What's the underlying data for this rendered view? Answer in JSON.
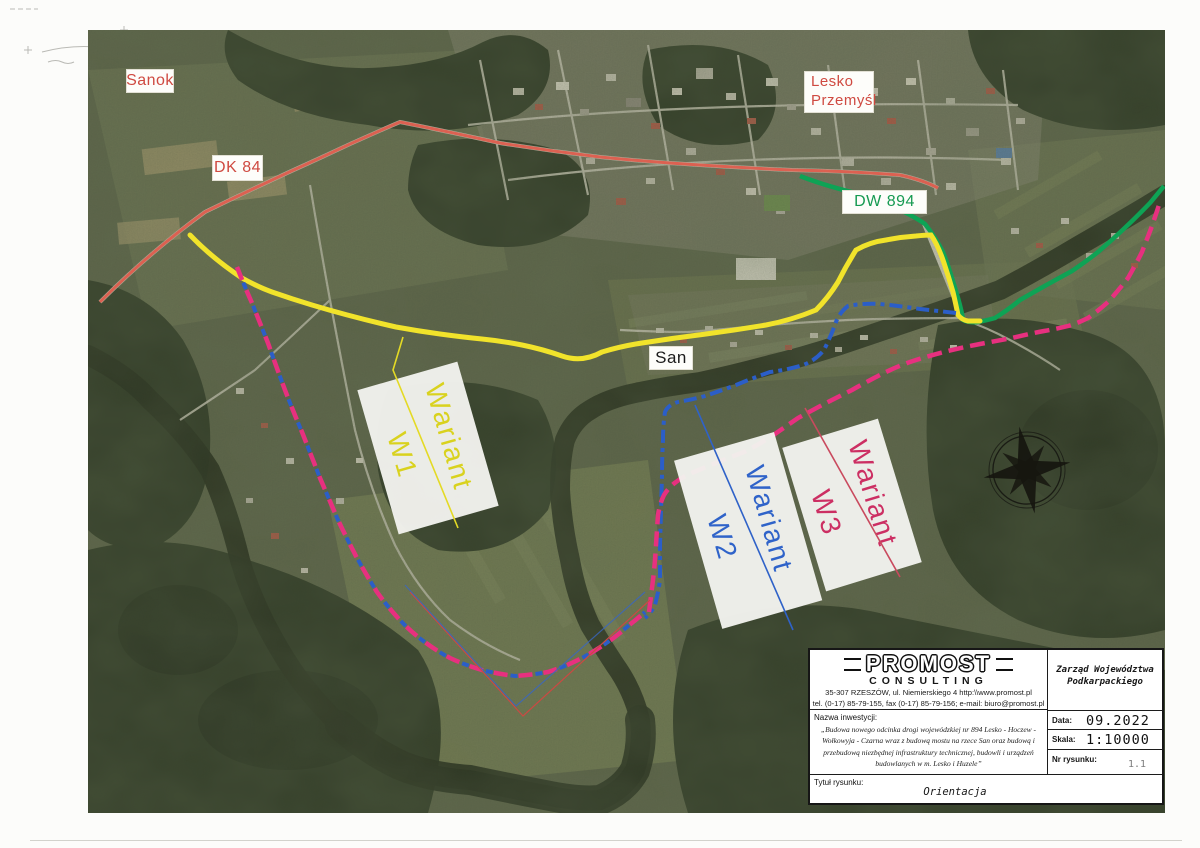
{
  "map": {
    "place_labels": {
      "sanok": "Sanok",
      "lesko_line1": "Lesko",
      "lesko_line2": "Przemyśl",
      "san": "San"
    },
    "road_labels": {
      "dk84": "DK 84",
      "dw894": "DW 894"
    },
    "variants": [
      {
        "word": "Wariant",
        "code": "W1",
        "color": "#ddd51e"
      },
      {
        "word": "Wariant",
        "code": "W2",
        "color": "#2f63c9"
      },
      {
        "word": "Wariant",
        "code": "W3",
        "color": "#cc2f63"
      }
    ],
    "route_colors": {
      "dk84": "#e05a4b",
      "dw894": "#0ea355",
      "wariant_w1": "#f1e32b",
      "wariant_w2": "#2b5ec8",
      "wariant_w3": "#e7307f"
    },
    "icons": {
      "compass": "compass-rose"
    }
  },
  "title_block": {
    "company": "PROMOST",
    "company_sub": "CONSULTING",
    "address_line1": "35-307 RZESZÓW, ul. Niemierskiego 4    http:\\\\www.promost.pl",
    "address_line2": "tel. (0-17) 85-79-155, fax (0-17) 85-79-156; e-mail: biuro@promost.pl",
    "investment_label": "Nazwa inwestycji:",
    "investment_name": "„Budowa nowego odcinka drogi wojewódzkiej nr 894 Lesko - Hoczew - Wołkowyja - Czarna wraz z budową mostu na rzece San oraz budową i przebudową niezbędnej infrastruktury technicznej, budowli i urządzeń budowlanych w m. Lesko i Huzele”",
    "client": "Zarząd Województwa Podkarpackiego",
    "date_label": "Data:",
    "date_value": "09.2022",
    "scale_label": "Skala:",
    "scale_value": "1:10000",
    "drawing_number_label": "Nr rysunku:",
    "drawing_number_value": "1.1",
    "drawing_title_label": "Tytuł rysunku:",
    "drawing_title_value": "Orientacja"
  }
}
